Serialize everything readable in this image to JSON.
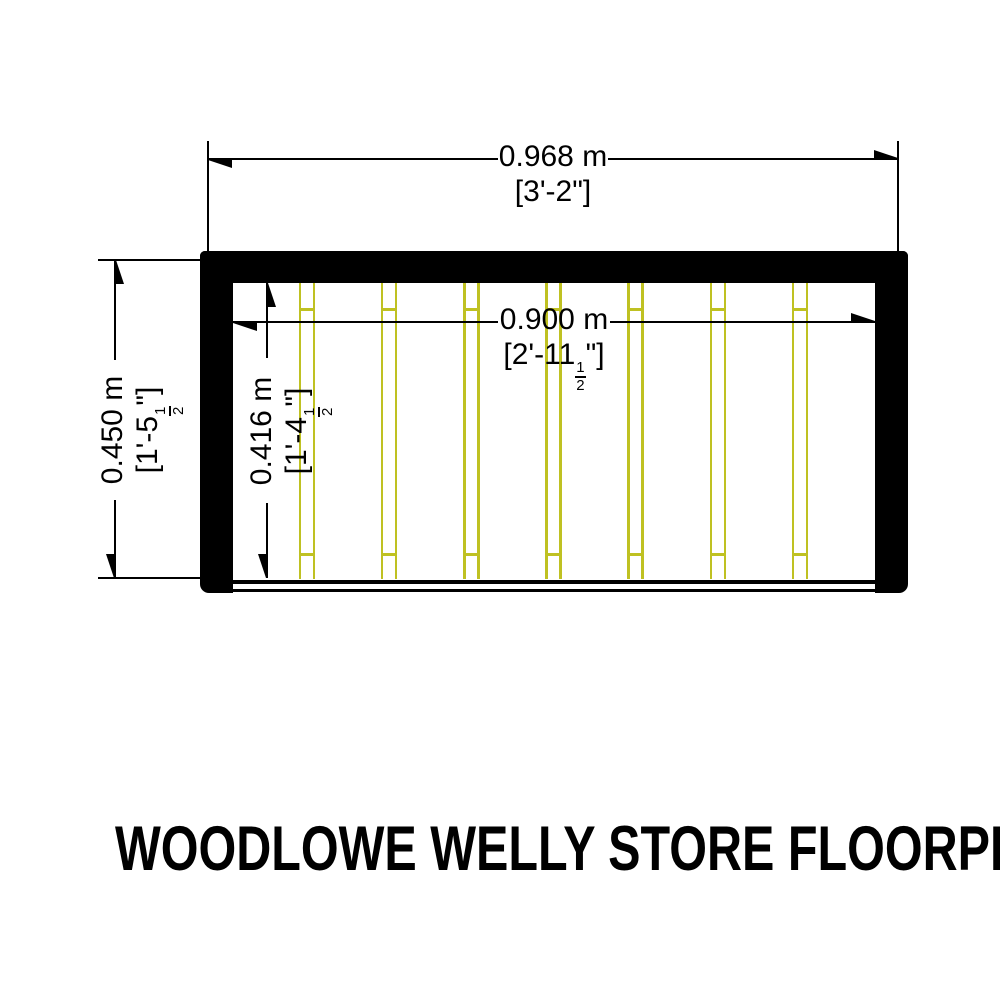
{
  "title": "WOODLOWE WELLY STORE FLOORPLAN",
  "colors": {
    "background": "#ffffff",
    "wall": "#000000",
    "line": "#000000",
    "joist": "#bfc122"
  },
  "plan": {
    "joist_count": 7
  },
  "dimensions": {
    "outer_width": {
      "metric": "0.968 m",
      "imp_pre": "[3'-2\"]",
      "imp_num": "",
      "imp_den": "",
      "imp_post": ""
    },
    "inner_width": {
      "metric": "0.900 m",
      "imp_pre": "[2'-11",
      "imp_num": "1",
      "imp_den": "2",
      "imp_post": "\"]"
    },
    "outer_depth": {
      "metric": "0.450 m",
      "imp_pre": "[1'-5",
      "imp_num": "1",
      "imp_den": "2",
      "imp_post": "\"]"
    },
    "inner_depth": {
      "metric": "0.416 m",
      "imp_pre": "[1'-4",
      "imp_num": "1",
      "imp_den": "2",
      "imp_post": "\"]"
    }
  }
}
